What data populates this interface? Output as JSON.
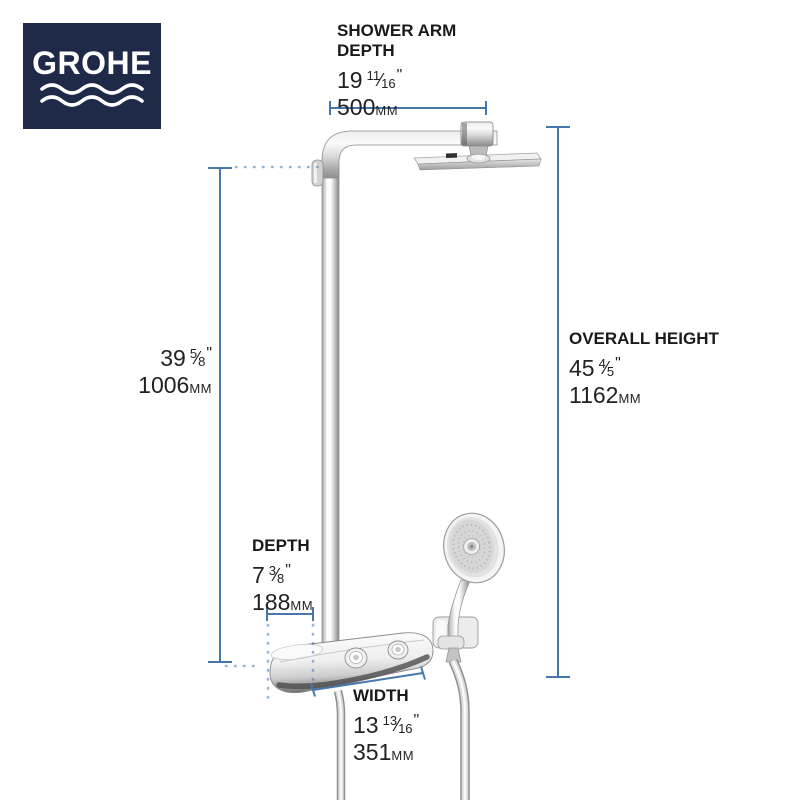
{
  "brand": {
    "name": "GROHE"
  },
  "symbols": {
    "inch_mark": "\"",
    "fraction_slash": "⁄"
  },
  "colors": {
    "brand_navy": "#1e2a47",
    "dimension_blue": "#4577ad",
    "text_color": "#1a1a1a"
  },
  "dimensions": {
    "shower_arm_depth": {
      "label_line1": "SHOWER ARM",
      "label_line2": "DEPTH",
      "inches_whole": "19",
      "frac_num": "11",
      "frac_den": "16",
      "mm_value": "500",
      "mm_unit": "mm"
    },
    "riser_height": {
      "inches_whole": "39",
      "frac_num": "5",
      "frac_den": "8",
      "mm_value": "1006",
      "mm_unit": "mm"
    },
    "overall_height": {
      "label": "OVERALL HEIGHT",
      "inches_whole": "45",
      "frac_num": "4",
      "frac_den": "5",
      "mm_value": "1162",
      "mm_unit": "mm"
    },
    "depth": {
      "label": "DEPTH",
      "inches_whole": "7",
      "frac_num": "3",
      "frac_den": "8",
      "mm_value": "188",
      "mm_unit": "mm"
    },
    "width": {
      "label": "WIDTH",
      "inches_whole": "13",
      "frac_num": "13",
      "frac_den": "16",
      "mm_value": "351",
      "mm_unit": "mm"
    }
  }
}
